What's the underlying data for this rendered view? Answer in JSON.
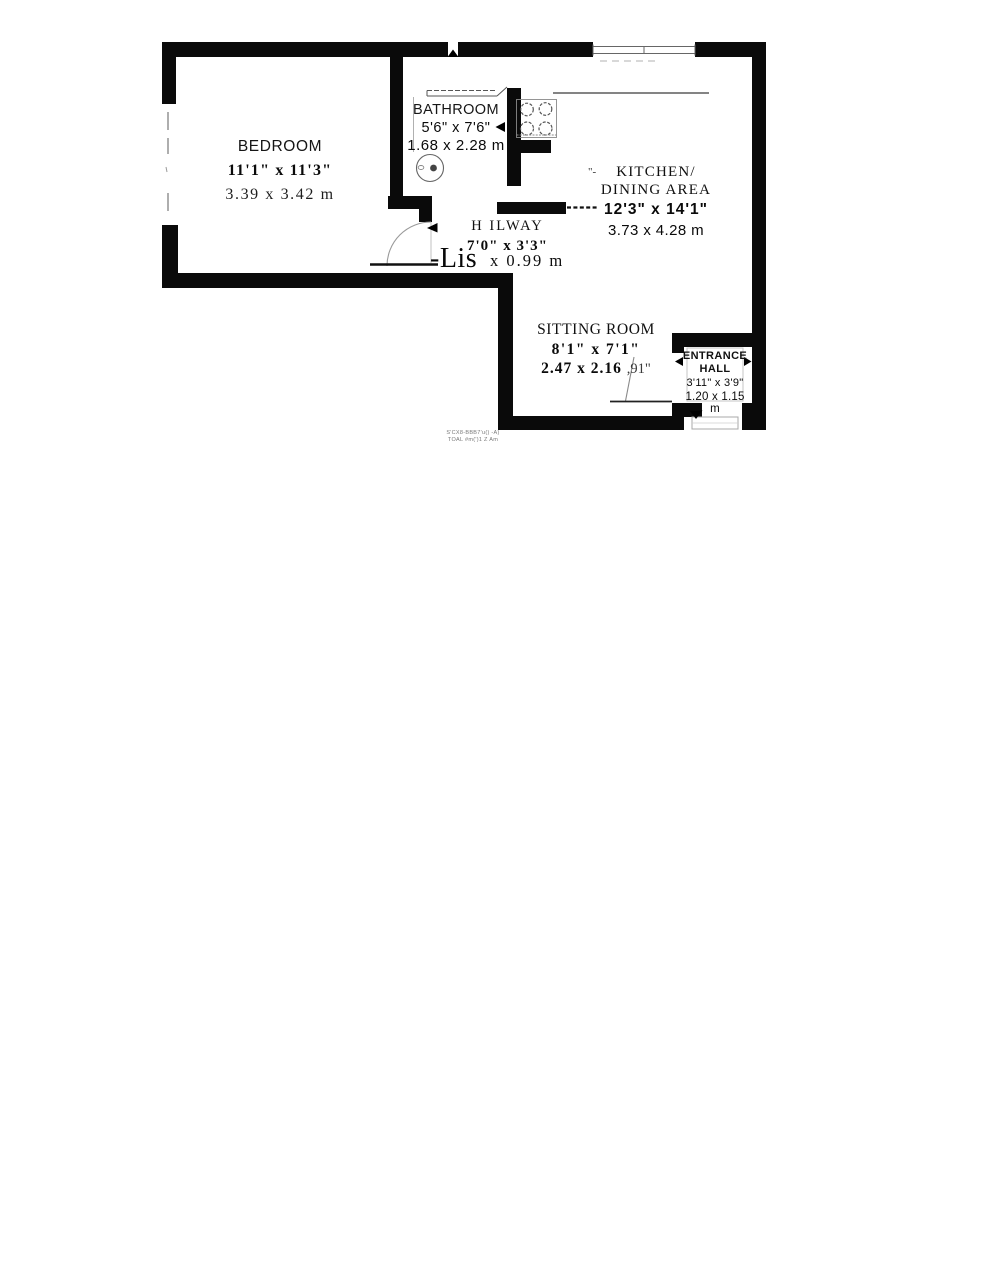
{
  "rooms": {
    "bedroom": {
      "name": "BEDROOM",
      "imperial": "11'1\" x 11'3\"",
      "metric": "3.39  x  3.42  m"
    },
    "bathroom": {
      "name": "BATHROOM",
      "imperial": "5'6\" x 7'6\"",
      "metric": "1.68 x 2.28 m"
    },
    "kitchen": {
      "name_line1": "KITCHEN/",
      "name_line2": "DINING  AREA",
      "imperial": "12'3\"  x  14'1\"",
      "metric": "3.73 x 4.28 m",
      "leader_artifact": "\"-"
    },
    "hallway": {
      "name": "H ILWAY",
      "imperial": "7'0\" x 3'3\"",
      "metric_artifact": "-Lis",
      "metric": "x 0.99  m"
    },
    "sitting_room": {
      "name": "SITTING ROOM",
      "imperial": "8'1\" x 7'1\"",
      "metric": "2.47  x  2.16",
      "artifact": ",91\""
    },
    "entrance_hall": {
      "name_line1": "ENTRANCE",
      "name_line2": "HALL",
      "imperial": "3'11\" x 3'9\"",
      "metric": "1.20 x 1.15 m"
    }
  },
  "footer": {
    "line1": "S'CX8-BBB7'u() -A)",
    "line2": "TOAL #m(')1 Z Am"
  },
  "colors": {
    "wall": "#0a0a0a",
    "paper": "#ffffff",
    "thin_line": "#666666"
  }
}
